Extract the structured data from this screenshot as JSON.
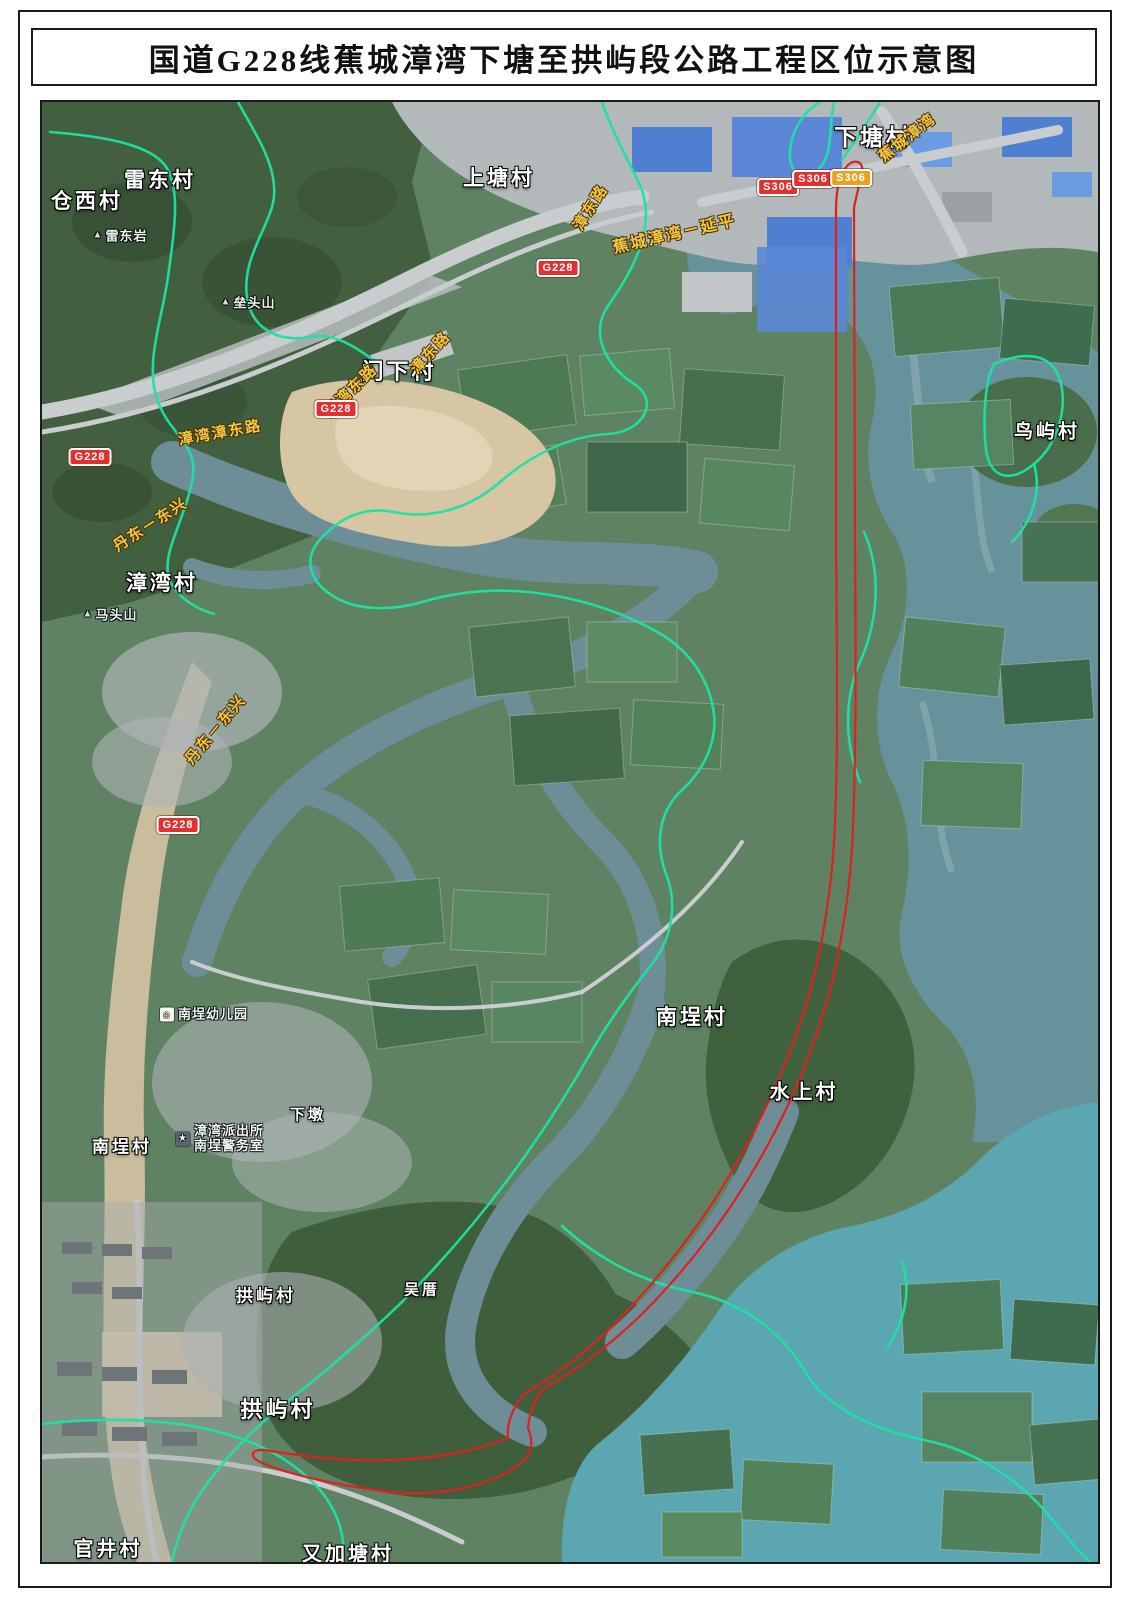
{
  "page": {
    "title": "国道G228线蕉城漳湾下塘至拱屿段公路工程区位示意图"
  },
  "map": {
    "colors": {
      "boundary_cyan": "#1ce2a4",
      "route_red": "#e02020",
      "road_label_yellow": "#f5c842",
      "shield_red": "#e03030",
      "shield_amber": "#e8a21f",
      "village_text": "#ffffff"
    },
    "village_labels": [
      {
        "text": "下塘村",
        "x": 831,
        "y": 33,
        "size": 23
      },
      {
        "text": "雷东村",
        "x": 118,
        "y": 77,
        "size": 21
      },
      {
        "text": "仓西村",
        "x": 45,
        "y": 98,
        "size": 21
      },
      {
        "text": "上塘村",
        "x": 457,
        "y": 75,
        "size": 21
      },
      {
        "text": "门下村",
        "x": 357,
        "y": 268,
        "size": 22
      },
      {
        "text": "漳湾村",
        "x": 120,
        "y": 480,
        "size": 21
      },
      {
        "text": "鸟屿村",
        "x": 1005,
        "y": 328,
        "size": 19
      },
      {
        "text": "南埕村",
        "x": 650,
        "y": 914,
        "size": 21
      },
      {
        "text": "水上村",
        "x": 762,
        "y": 988,
        "size": 20
      },
      {
        "text": "南埕村",
        "x": 80,
        "y": 1043,
        "size": 17
      },
      {
        "text": "下墩",
        "x": 266,
        "y": 1012,
        "size": 15
      },
      {
        "text": "拱屿村",
        "x": 224,
        "y": 1192,
        "size": 17
      },
      {
        "text": "吴厝",
        "x": 380,
        "y": 1187,
        "size": 15
      },
      {
        "text": "拱屿村",
        "x": 236,
        "y": 1306,
        "size": 22
      },
      {
        "text": "官井村",
        "x": 66,
        "y": 1445,
        "size": 20
      },
      {
        "text": "又加塘村",
        "x": 306,
        "y": 1450,
        "size": 20
      }
    ],
    "mountain_labels": [
      {
        "text": "雷东岩",
        "x": 78,
        "y": 133
      },
      {
        "text": "垒头山",
        "x": 206,
        "y": 200
      },
      {
        "text": "马头山",
        "x": 68,
        "y": 512
      }
    ],
    "poi_labels": [
      {
        "text": "南埕幼儿园",
        "icon": "school",
        "x": 162,
        "y": 913
      },
      {
        "lines": [
          "漳湾派出所",
          "南埕警务室"
        ],
        "icon": "police-star",
        "x": 178,
        "y": 1037
      }
    ],
    "road_labels": [
      {
        "text": "蕉城漳湾",
        "x": 865,
        "y": 35,
        "rotate": -38,
        "size": 15
      },
      {
        "text": "漳东路",
        "x": 548,
        "y": 105,
        "rotate": -58,
        "size": 15
      },
      {
        "text": "蕉城漳湾－延平",
        "x": 632,
        "y": 130,
        "rotate": -13,
        "size": 16
      },
      {
        "text": "漳东路",
        "x": 388,
        "y": 250,
        "rotate": -48,
        "size": 15
      },
      {
        "text": "漳湾东路",
        "x": 308,
        "y": 288,
        "rotate": -44,
        "size": 15
      },
      {
        "text": "漳湾漳东路",
        "x": 178,
        "y": 330,
        "rotate": -10,
        "size": 15
      },
      {
        "text": "丹东－东兴",
        "x": 108,
        "y": 422,
        "rotate": -33,
        "size": 15
      },
      {
        "text": "丹东－东兴",
        "x": 173,
        "y": 627,
        "rotate": -50,
        "size": 15
      }
    ],
    "shields": [
      {
        "text": "G228",
        "type": "red",
        "x": 516,
        "y": 166
      },
      {
        "text": "G228",
        "type": "red",
        "x": 294,
        "y": 307
      },
      {
        "text": "G228",
        "type": "red",
        "x": 48,
        "y": 355
      },
      {
        "text": "G228",
        "type": "red",
        "x": 136,
        "y": 723
      },
      {
        "text": "S306",
        "type": "red",
        "x": 736,
        "y": 85
      },
      {
        "text": "S306",
        "type": "red",
        "x": 771,
        "y": 77
      },
      {
        "text": "S306",
        "type": "amber",
        "x": 809,
        "y": 76
      }
    ]
  }
}
